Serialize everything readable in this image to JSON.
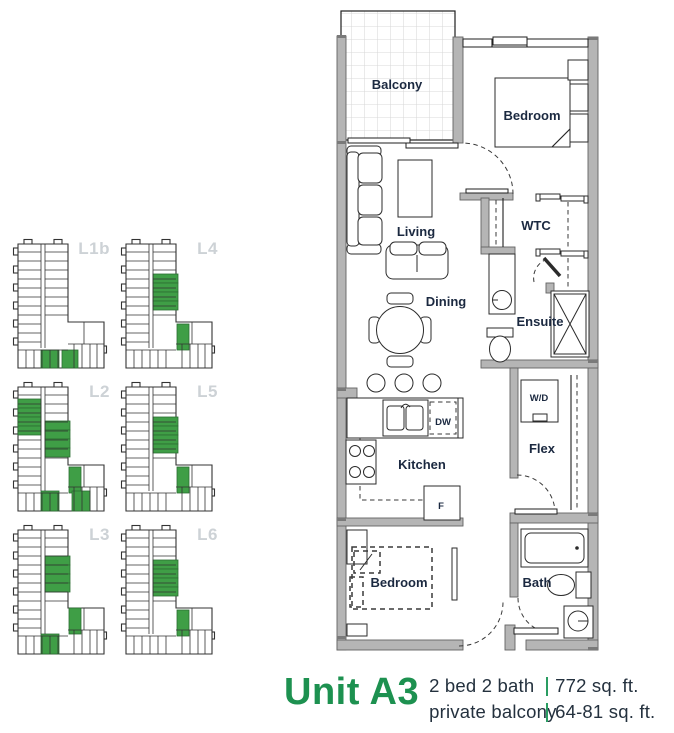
{
  "unit": {
    "title": "Unit A3",
    "specs": [
      {
        "left": "2 bed 2 bath",
        "right": "772 sq. ft."
      },
      {
        "left": "private balcony",
        "right": "64-81 sq. ft."
      }
    ]
  },
  "colors": {
    "accent_green": "#1d9150",
    "highlight_green": "#3f9e46",
    "navy_text": "#24313e",
    "keyplan_label_gray": "#cdd2d6",
    "wall_gray": "#b5b5b5"
  },
  "floorplan": {
    "rooms": [
      {
        "id": "balcony",
        "label": "Balcony"
      },
      {
        "id": "bedroom-1",
        "label": "Bedroom"
      },
      {
        "id": "living",
        "label": "Living"
      },
      {
        "id": "wtc",
        "label": "WTC"
      },
      {
        "id": "dining",
        "label": "Dining"
      },
      {
        "id": "ensuite",
        "label": "Ensuite"
      },
      {
        "id": "wd",
        "label": "W/D"
      },
      {
        "id": "flex",
        "label": "Flex"
      },
      {
        "id": "kitchen",
        "label": "Kitchen"
      },
      {
        "id": "dw",
        "label": "DW"
      },
      {
        "id": "fridge",
        "label": "F"
      },
      {
        "id": "bedroom-2",
        "label": "Bedroom"
      },
      {
        "id": "bath",
        "label": "Bath"
      }
    ]
  },
  "keyplans": {
    "levels": [
      {
        "label": "L1b",
        "green_units": [
          [
            29,
            112,
            18,
            18
          ],
          [
            50,
            112,
            16,
            18
          ]
        ]
      },
      {
        "label": "L4",
        "green_units": [
          [
            33,
            36,
            25,
            9
          ],
          [
            33,
            45,
            25,
            9
          ],
          [
            33,
            54,
            25,
            9
          ],
          [
            33,
            63,
            25,
            9
          ],
          [
            57,
            86,
            12,
            26
          ]
        ]
      },
      {
        "label": "L2",
        "green_units": [
          [
            6,
            18,
            23,
            9
          ],
          [
            6,
            27,
            23,
            9
          ],
          [
            6,
            36,
            23,
            9
          ],
          [
            6,
            45,
            23,
            9
          ],
          [
            33,
            40,
            25,
            9
          ],
          [
            33,
            49,
            25,
            9
          ],
          [
            33,
            58,
            25,
            9
          ],
          [
            33,
            67,
            25,
            9
          ],
          [
            57,
            86,
            12,
            26
          ],
          [
            29,
            110,
            18,
            20
          ],
          [
            60,
            110,
            18,
            20
          ]
        ]
      },
      {
        "label": "L5",
        "green_units": [
          [
            33,
            36,
            25,
            9
          ],
          [
            33,
            45,
            25,
            9
          ],
          [
            33,
            54,
            25,
            9
          ],
          [
            33,
            63,
            25,
            9
          ],
          [
            57,
            86,
            12,
            26
          ]
        ]
      },
      {
        "label": "L3",
        "green_units": [
          [
            33,
            32,
            25,
            9
          ],
          [
            33,
            41,
            25,
            9
          ],
          [
            33,
            50,
            25,
            9
          ],
          [
            33,
            59,
            25,
            9
          ],
          [
            57,
            84,
            12,
            26
          ],
          [
            29,
            110,
            18,
            20
          ]
        ]
      },
      {
        "label": "L6",
        "green_units": [
          [
            33,
            36,
            25,
            9
          ],
          [
            33,
            45,
            25,
            9
          ],
          [
            33,
            54,
            25,
            9
          ],
          [
            33,
            63,
            25,
            9
          ],
          [
            57,
            86,
            12,
            26
          ]
        ]
      }
    ]
  }
}
